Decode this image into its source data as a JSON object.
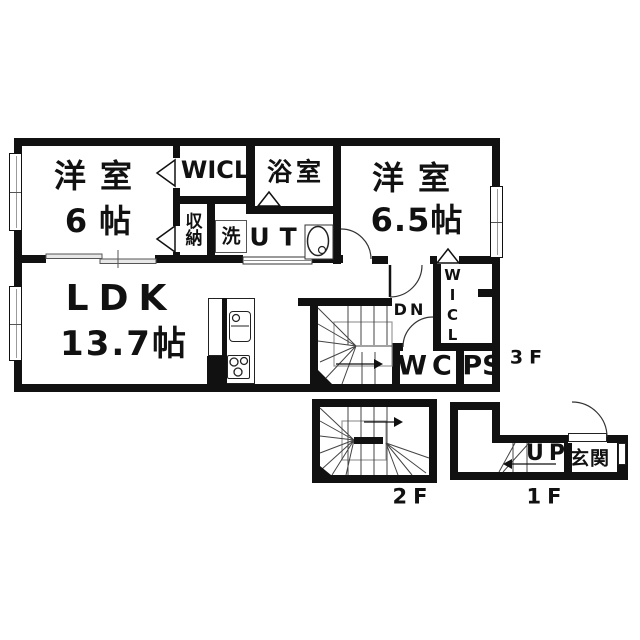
{
  "colors": {
    "wall": "#111111",
    "line": "#444444",
    "gray": "#999999",
    "bg": "#ffffff"
  },
  "floor3": {
    "room1_line1": "洋室",
    "room1_line2": "6帖",
    "wicl_top": "WICL",
    "bath": "浴室",
    "room2_line1": "洋室",
    "room2_line2": "6.5帖",
    "storage": "収納",
    "washer": "洗",
    "ut": "UT",
    "ldk_line1": "LDK",
    "ldk_line2": "13.7帖",
    "dn": "DN",
    "wicl_side": "WICL",
    "wc": "WC",
    "ps": "PS",
    "floor_label": "3F"
  },
  "floor2": {
    "floor_label": "2F"
  },
  "floor1": {
    "up": "UP",
    "entrance": "玄関",
    "floor_label": "1F"
  }
}
